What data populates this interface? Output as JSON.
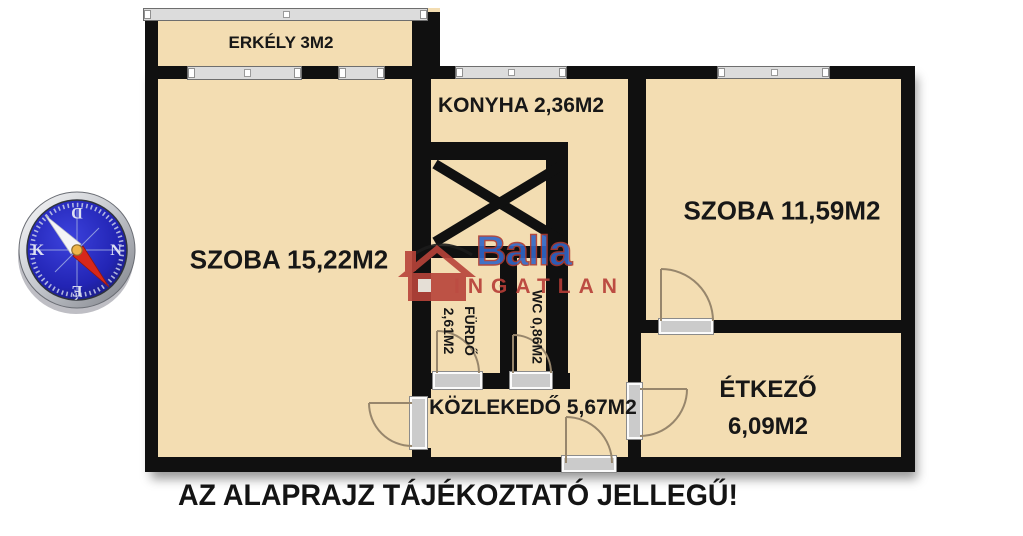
{
  "colors": {
    "floor": "#f3ddb2",
    "wall": "#101010",
    "window-fill": "#dcdcdc",
    "arc": "#97866c",
    "brand": "#2e66c9",
    "accent": "#b73d36"
  },
  "rooms": {
    "erkely": {
      "label": "ERKÉLY 3M2"
    },
    "konyha": {
      "label": "KONYHA 2,36M2"
    },
    "szoba_nagy": {
      "label": "SZOBA 15,22M2"
    },
    "szoba_kis": {
      "label": "SZOBA 11,59M2"
    },
    "furdo": {
      "name": "FÜRDŐ",
      "area": "2,61M2"
    },
    "wc": {
      "label": "WC 0,86M2"
    },
    "kozlekedo": {
      "label": "KÖZLEKEDŐ 5,67M2"
    },
    "etkezo": {
      "name": "ÉTKEZŐ",
      "area": "6,09M2"
    }
  },
  "compass": {
    "top": "D",
    "right": "N",
    "bottom": "É",
    "left": "K"
  },
  "watermark": {
    "brand": "Balla",
    "subbrand": "INGATLAN"
  },
  "footer": {
    "note": "AZ ALAPRAJZ TÁJÉKOZTATÓ JELLEGŰ!"
  }
}
